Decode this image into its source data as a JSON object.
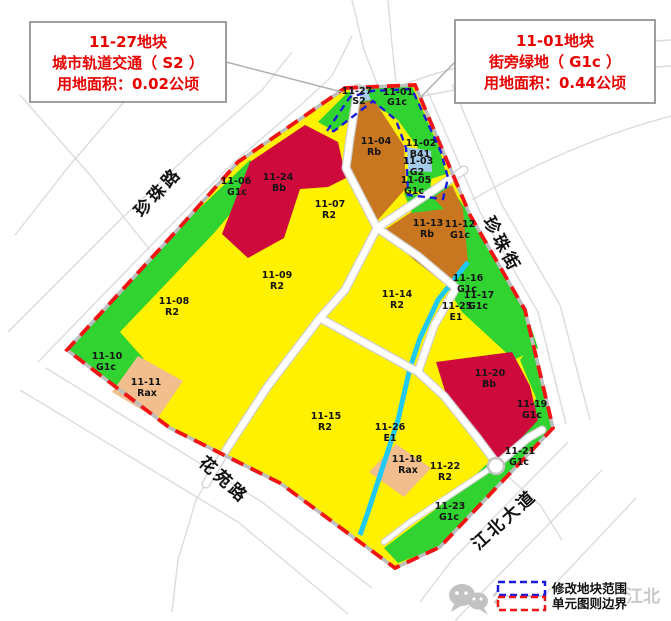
{
  "callouts": {
    "left": {
      "lines": [
        "11-27地块",
        "城市轨道交通（ S2 ）",
        "用地面积：0.02公顷"
      ]
    },
    "right": {
      "lines": [
        "11-01地块",
        "街旁绿地（ G1c ）",
        "用地面积：0.44公顷"
      ]
    }
  },
  "roads": {
    "northwest": "珍珠路",
    "east": "珍珠街",
    "southwest": "花苑路",
    "southeast": "江北大道"
  },
  "parcels": [
    {
      "id": "11-27",
      "code": "S2"
    },
    {
      "id": "11-01",
      "code": "G1c"
    },
    {
      "id": "11-04",
      "code": "Rb"
    },
    {
      "id": "11-02",
      "code": "B41"
    },
    {
      "id": "11-03",
      "code": "G2"
    },
    {
      "id": "11-05",
      "code": "G1c"
    },
    {
      "id": "11-06",
      "code": "G1c"
    },
    {
      "id": "11-24",
      "code": "Bb"
    },
    {
      "id": "11-07",
      "code": "R2"
    },
    {
      "id": "11-13",
      "code": "Rb"
    },
    {
      "id": "11-12",
      "code": "G1c"
    },
    {
      "id": "11-09",
      "code": "R2"
    },
    {
      "id": "11-08",
      "code": "R2"
    },
    {
      "id": "11-14",
      "code": "R2"
    },
    {
      "id": "11-16",
      "code": "G1c"
    },
    {
      "id": "11-17",
      "code": "G1c"
    },
    {
      "id": "11-25",
      "code": "E1"
    },
    {
      "id": "11-10",
      "code": "G1c"
    },
    {
      "id": "11-11",
      "code": "Rax"
    },
    {
      "id": "11-20",
      "code": "Bb"
    },
    {
      "id": "11-19",
      "code": "G1c"
    },
    {
      "id": "11-15",
      "code": "R2"
    },
    {
      "id": "11-26",
      "code": "E1"
    },
    {
      "id": "11-18",
      "code": "Rax"
    },
    {
      "id": "11-22",
      "code": "R2"
    },
    {
      "id": "11-21",
      "code": "G1c"
    },
    {
      "id": "11-23",
      "code": "G1c"
    }
  ],
  "legend": {
    "items": [
      {
        "label": "修改地块范围",
        "color": "#1a1adc",
        "style": "dashed"
      },
      {
        "label": "单元图则边界",
        "color": "#f01414",
        "style": "dashed"
      }
    ]
  },
  "watermark": {
    "icon": "wechat",
    "prefix": "公众号",
    "suffix": "江北"
  },
  "land_use_colors": {
    "R2": "#fff100",
    "Rb": "#c8761f",
    "Bb": "#ce0a3c",
    "G1c": "#30d330",
    "G2": "#30d330",
    "Rax": "#f2be8d",
    "B41": "#a5cbec",
    "S2": "#a5cbec",
    "E1": "#1fc9f2"
  }
}
